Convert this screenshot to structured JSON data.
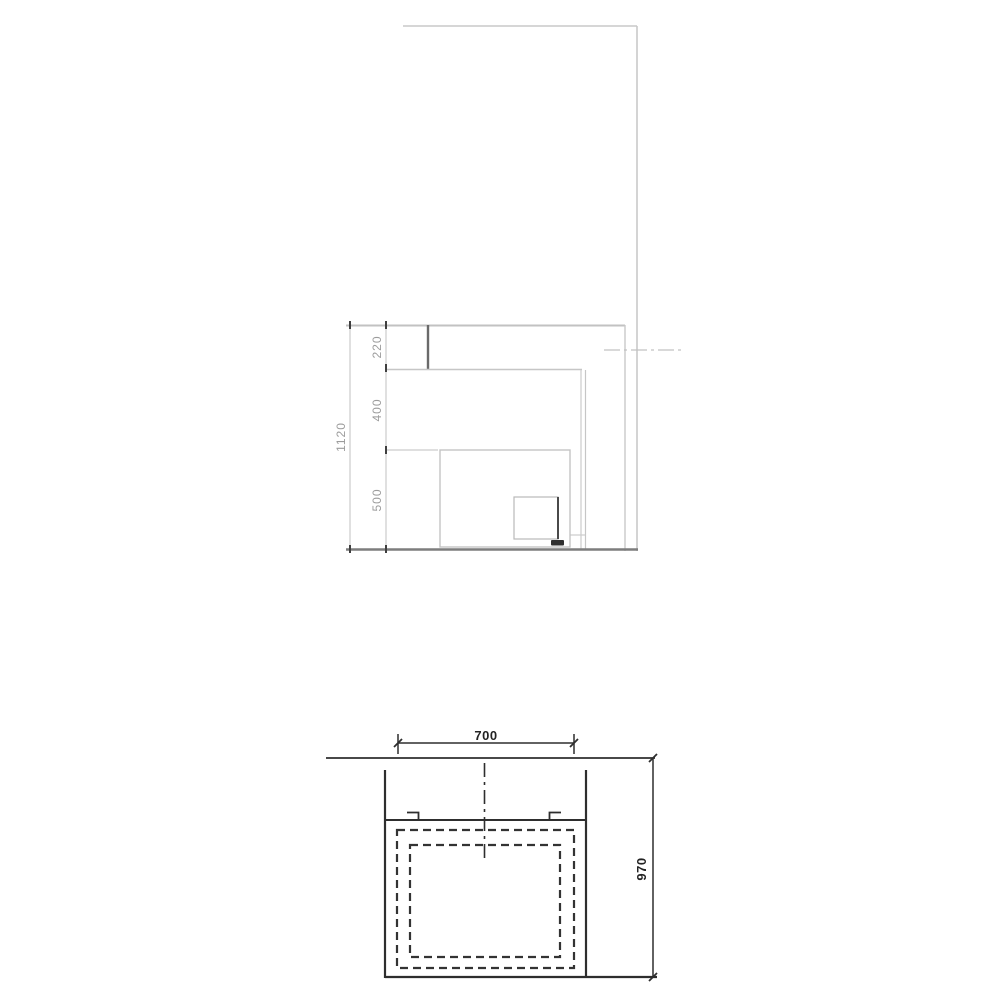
{
  "page": {
    "background": "#ffffff",
    "type": "technical-drawing"
  },
  "colors": {
    "line_light": "#c6c6c6",
    "line_medium": "#8f8f8f",
    "line_dark": "#2e2e2e",
    "tick_dark": "#3f3f3f",
    "text_gray": "#9c9c9c",
    "text_dark": "#232323"
  },
  "section_view": {
    "dim_total_height": "1120",
    "dim_segment_top": "220",
    "dim_segment_middle": "400",
    "dim_segment_bottom": "500"
  },
  "plan_view": {
    "dim_width": "700",
    "dim_depth": "970"
  }
}
